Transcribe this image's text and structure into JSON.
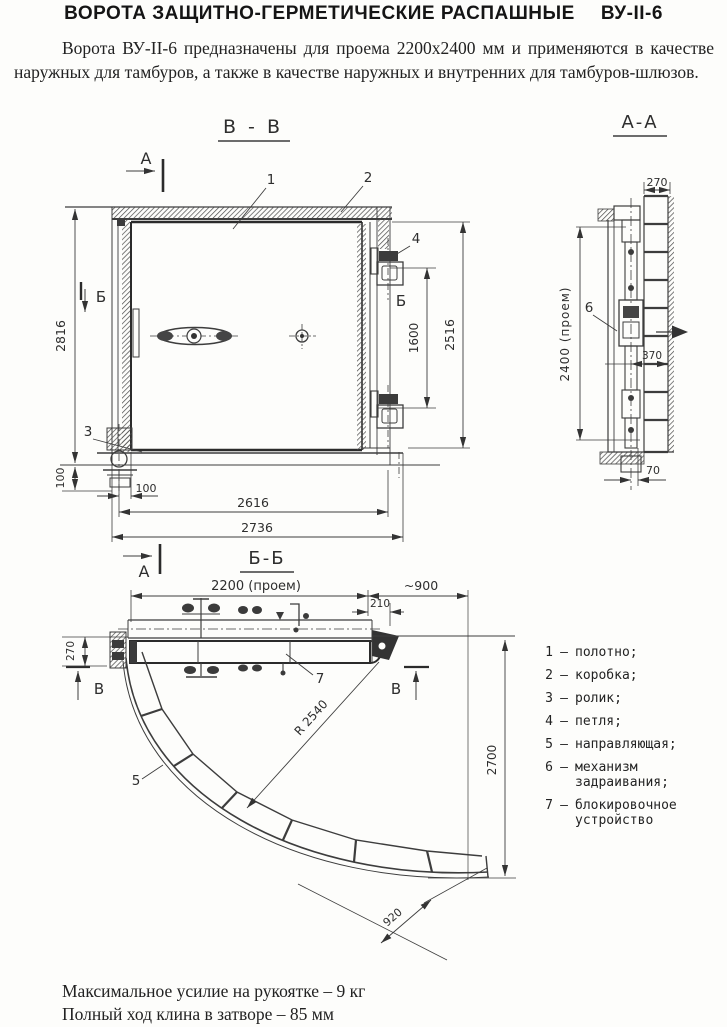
{
  "page": {
    "title": "ВОРОТА ЗАЩИТНО-ГЕРМЕТИЧЕСКИЕ РАСПАШНЫЕ",
    "title_code": "ВУ-II-6"
  },
  "intro": "Ворота ВУ-II-6 предназначены для проема 2200х2400 мм и применяются в качестве наружных для тамбуров, а также в качестве наружных и внутренних для тамбуров-шлюзов.",
  "views": {
    "front": "В - В",
    "side": "А-А",
    "plan": "Б-Б"
  },
  "markers": {
    "a": "А",
    "b": "Б",
    "v": "В"
  },
  "parts": {
    "p1": "1",
    "p2": "2",
    "p3": "3",
    "p4": "4",
    "p5": "5",
    "p6": "6",
    "p7": "7"
  },
  "dims": {
    "front": {
      "total_height": "2816",
      "sill_height": "100",
      "roller_offset": "100",
      "leaf_width": "2616",
      "total_width": "2736",
      "hinge_span": "1600",
      "right_height": "2516"
    },
    "side": {
      "frame_depth": "270",
      "opening_height": "2400 (проем)",
      "axis_offset": "370",
      "bottom_offset": "70"
    },
    "plan": {
      "opening_width": "2200 (проем)",
      "swing": "~900",
      "hinge_offset": "210",
      "leaf_thickness": "270",
      "guide_radius": "R 2540",
      "arc_chord": "920",
      "swing_height": "2700"
    }
  },
  "legend": {
    "separator": "–",
    "items": [
      {
        "num": "1",
        "text": "полотно;"
      },
      {
        "num": "2",
        "text": "коробка;"
      },
      {
        "num": "3",
        "text": "ролик;"
      },
      {
        "num": "4",
        "text": "петля;"
      },
      {
        "num": "5",
        "text": "направляющая;"
      },
      {
        "num": "6",
        "text": "механизм задраивания;"
      },
      {
        "num": "7",
        "text": "блокировочное устройство"
      }
    ]
  },
  "footer": {
    "line1": "Максимальное усилие на рукоятке – 9 кг",
    "line2": "Полный ход клина в затворе – 85 мм"
  }
}
